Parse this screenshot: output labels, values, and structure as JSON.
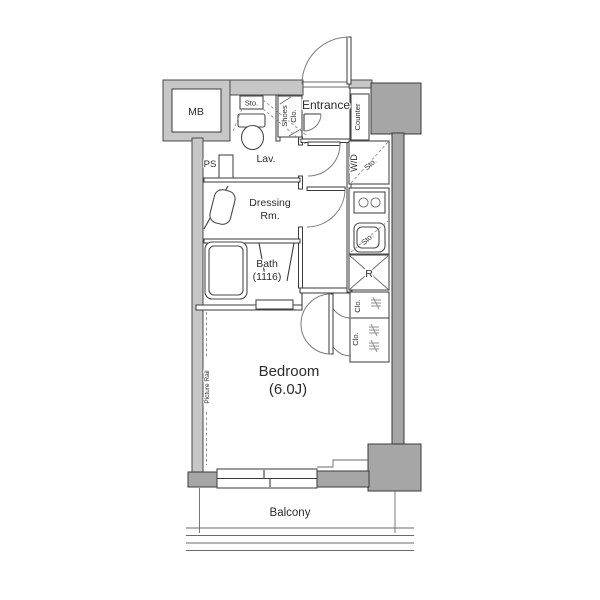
{
  "plan_title": "1K apartment floor plan",
  "colors": {
    "wall-light": "#c7c7c7",
    "wall-dark": "#a6a6a6",
    "line": "#3a3a3a",
    "dash": "#909090",
    "text": "#2b2b2b",
    "bg": "#ffffff"
  },
  "labels": {
    "meter_box": "MB",
    "toilet_storage": "Sto.",
    "shoes_closet_line1": "Shoes",
    "shoes_closet_line2": "Clo.",
    "entrance": "Entrance",
    "counter": "Counter",
    "pipe_space": "PS",
    "lavatory": "Lav.",
    "washer_dryer": "W/D",
    "wd_storage": "Sto.",
    "sink_storage": "Sto.",
    "refrigerator": "R",
    "dressing_room_line1": "Dressing",
    "dressing_room_line2": "Rm.",
    "bath_line1": "Bath",
    "bath_line2": "(1116)",
    "closet_upper": "Clo.",
    "closet_lower": "Clo.",
    "bedroom_line1": "Bedroom",
    "bedroom_line2": "(6.0J)",
    "picture_rail": "Picture Rail",
    "balcony": "Balcony"
  }
}
